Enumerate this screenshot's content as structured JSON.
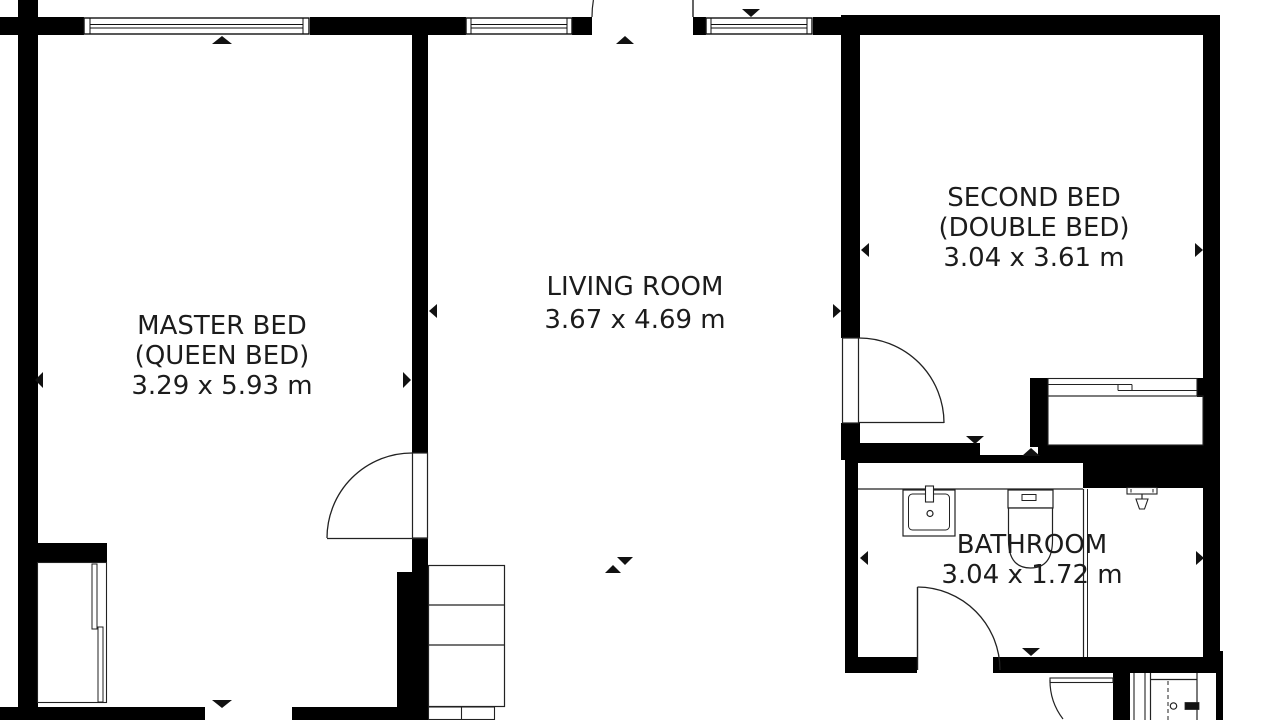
{
  "title": "Apartment floor plan",
  "colors": {
    "wall": "#000000",
    "line": "#222222",
    "background": "#ffffff",
    "text": "#1c1c1c"
  },
  "rooms": [
    {
      "name": "MASTER BED",
      "subtitle": "(QUEEN BED)",
      "dimensions": "3.29 x 5.93 m"
    },
    {
      "name": "LIVING ROOM",
      "subtitle": "",
      "dimensions": "3.67 x 4.69 m"
    },
    {
      "name": "SECOND BED",
      "subtitle": "(DOUBLE BED)",
      "dimensions": "3.04 x 3.61 m"
    },
    {
      "name": "BATHROOM",
      "subtitle": "",
      "dimensions": "3.04 x 1.72 m"
    }
  ],
  "fixtures": [
    {
      "icon": "sink-icon"
    },
    {
      "icon": "toilet-icon"
    },
    {
      "icon": "shower-head-icon"
    },
    {
      "icon": "wardrobe-sliding-doors-icon"
    },
    {
      "icon": "shelving-unit-icon"
    },
    {
      "icon": "door-swing-icon"
    },
    {
      "icon": "window-icon"
    },
    {
      "icon": "dimension-arrow-icon"
    },
    {
      "icon": "entry-door-icon"
    }
  ]
}
